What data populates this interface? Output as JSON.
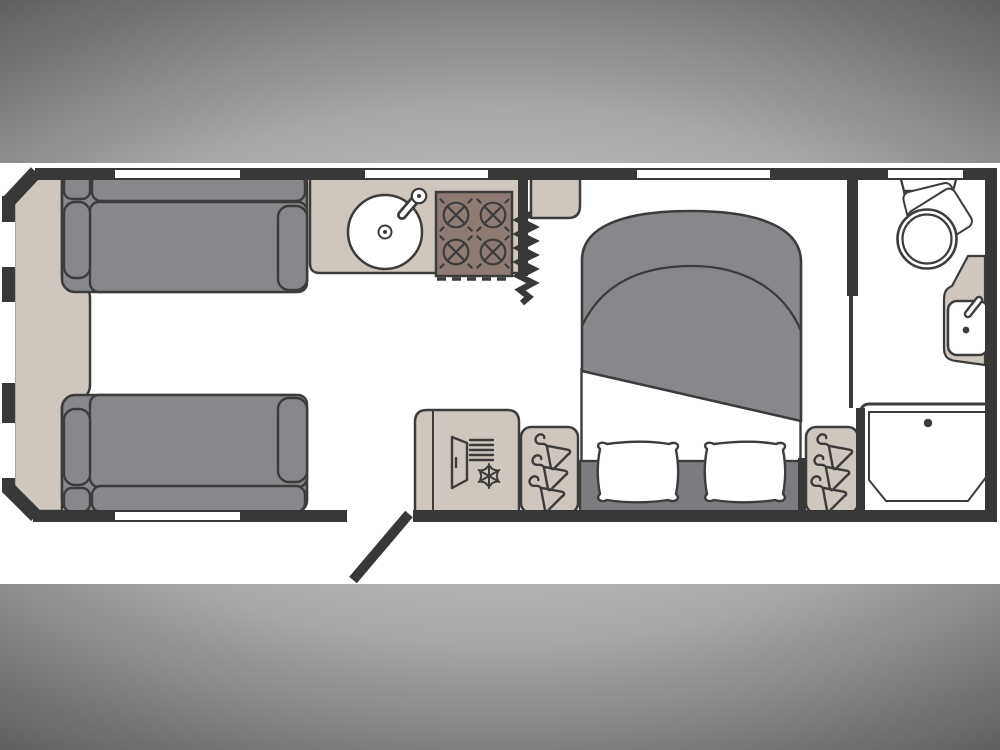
{
  "diagram": {
    "title": "Caravan floor plan",
    "colors": {
      "background_edge": "#171717",
      "background_mid": "#a9a7a5",
      "background_light": "#d8d6d4",
      "floor": "#ffffff",
      "wall": "#383838",
      "outline": "#3c3c3c",
      "upholstery": "#86888b",
      "bed_base": "#7a7c7f",
      "cabinetry": "#cfc6bd",
      "hob": "#8d7b74"
    },
    "rooms": [
      {
        "name": "front lounge"
      },
      {
        "name": "kitchen"
      },
      {
        "name": "bedroom"
      },
      {
        "name": "washroom"
      }
    ],
    "furniture": [
      "front-chest",
      "sofa",
      "sofa",
      "kitchen-sink",
      "hob",
      "zigzag-divider",
      "overhead-shelf",
      "island-bed",
      "pillow",
      "pillow",
      "refrigerator",
      "wardrobe",
      "wardrobe",
      "toilet",
      "washbasin",
      "shower-tray",
      "entry-door",
      "window"
    ]
  }
}
